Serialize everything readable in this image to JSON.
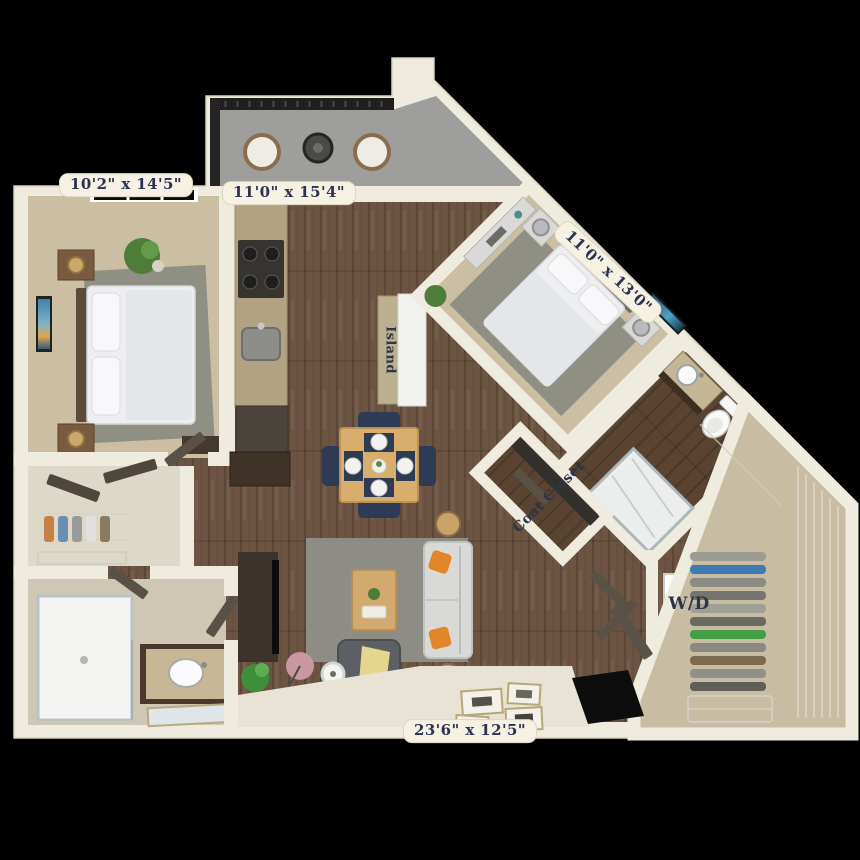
{
  "floorplan": {
    "dimension_labels": {
      "bedroom1": "10'2\" x 14'5\"",
      "balcony": "11'0\" x 15'4\"",
      "bedroom2": "11'0\" x 13'0\"",
      "living": "23'6\" x 12'5\""
    },
    "room_labels": {
      "coat_closet": "Coat Closet",
      "island": "Island",
      "washer_dryer": "W/D"
    },
    "colors": {
      "background": "#000000",
      "walls": "#f0ebdf",
      "wood_floor": "#6d5442",
      "dark_wood_floor": "#57412f",
      "carpet": "#cbbea2",
      "balcony_floor": "#9e9e9c",
      "rug": "#8d8d85",
      "accent_pillow": "#e2862a",
      "dining_chair": "#2e3b54",
      "throw_blanket": "#e6d68d",
      "label_text": "#2b3352",
      "label_bg": "#f6f1e3"
    }
  }
}
